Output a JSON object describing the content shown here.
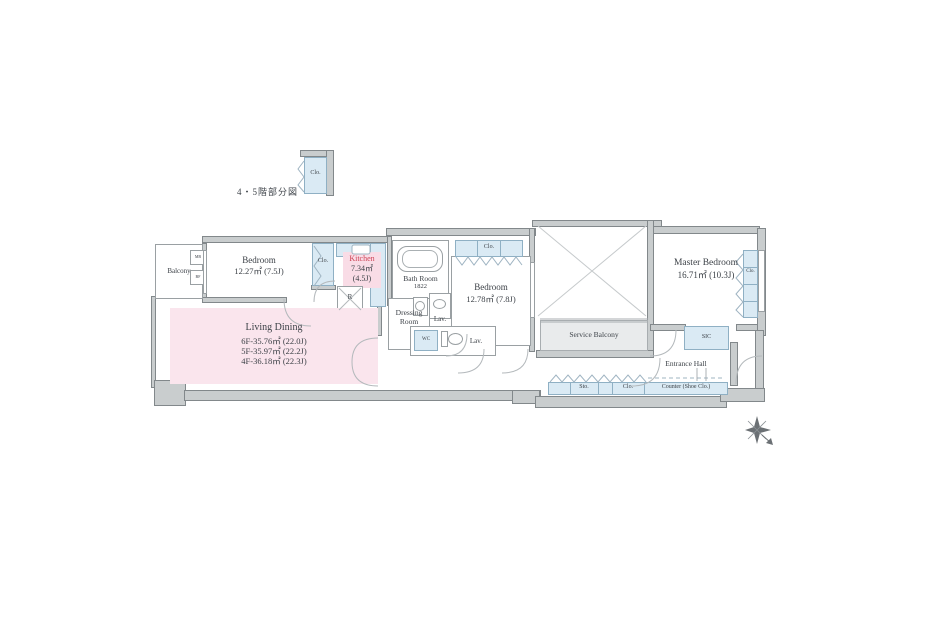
{
  "plan": {
    "partial_label": "4・5階部分図",
    "detached_closet": {
      "label": "Clo."
    },
    "balcony": {
      "label": "Balcony",
      "box_top": "MB",
      "box_bottom": "BF"
    },
    "bedroom1": {
      "name": "Bedroom",
      "area": "12.27㎡ (7.5J)"
    },
    "closet1": {
      "label": "Clo."
    },
    "kitchen": {
      "name": "Kitchen",
      "area": "7.34㎡",
      "tatami": "(4.5J)",
      "fridge_label": "R"
    },
    "bathroom": {
      "name": "Bath Room",
      "size": "1822"
    },
    "closet2": {
      "label": "Clo."
    },
    "bedroom2": {
      "name": "Bedroom",
      "area": "12.78㎡ (7.8J)"
    },
    "dressing_room": {
      "line1": "Dressing",
      "line2": "Room"
    },
    "lavatory1": {
      "label": "Lav."
    },
    "wc": {
      "label": "WC"
    },
    "lavatory2": {
      "label": "Lav."
    },
    "living_dining": {
      "name": "Living Dining",
      "areas": [
        "6F-35.76㎡ (22.0J)",
        "5F-35.97㎡ (22.2J)",
        "4F-36.18㎡ (22.3J)"
      ]
    },
    "service_balcony": {
      "label": "Service Balcony"
    },
    "master_bedroom": {
      "name": "Master Bedroom",
      "area": "16.71㎡ (10.3J)"
    },
    "closet3": {
      "label": "Clo."
    },
    "sic": {
      "label": "SIC"
    },
    "entrance_hall": {
      "label": "Entrance Hall"
    },
    "storage_row": {
      "sto": "Sto.",
      "clo": "Clo.",
      "counter": "Counter (Shoe Clo.)"
    },
    "colors": {
      "wall": "#c9cdce",
      "closet_fill": "#daeaf4",
      "living_fill": "#fae5ed",
      "kitchen_highlight": "#f9dce6",
      "kitchen_text": "#cd4255",
      "service_balcony_fill": "#e9ebec"
    }
  }
}
